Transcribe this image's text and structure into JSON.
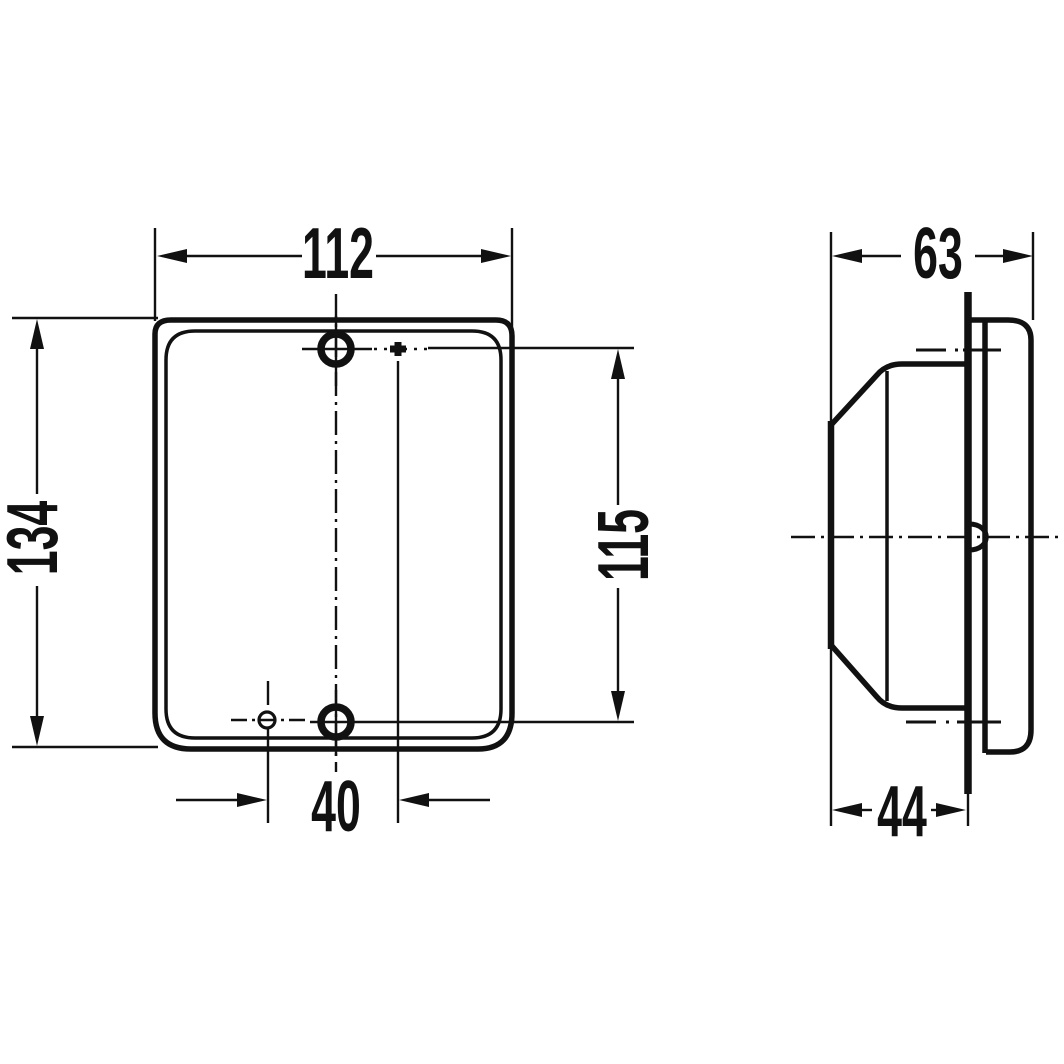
{
  "drawing": {
    "kind": "technical-dimension-drawing",
    "views": {
      "front": {
        "label": "front-view",
        "dimensions": {
          "width": "112",
          "height": "134",
          "hole_spacing_vertical": "115",
          "hole_offset_horizontal": "40"
        }
      },
      "side": {
        "label": "side-view",
        "dimensions": {
          "depth_total": "63",
          "depth_to_mounting_plane": "44"
        }
      }
    },
    "colors": {
      "ink": "#111111",
      "paper": "#ffffff"
    }
  }
}
